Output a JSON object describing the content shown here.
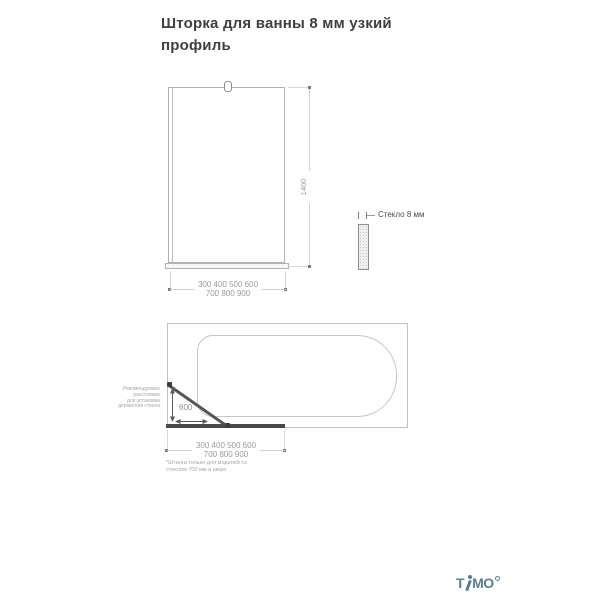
{
  "page": {
    "title_line1": "Шторка для ванны 8 мм узкий",
    "title_line2": "профиль"
  },
  "front_view": {
    "height_dim": "1400",
    "width_row1": "300 400 500 600",
    "width_row2": "700 800 900"
  },
  "glass_section": {
    "label": "Стекло 8 мм"
  },
  "plan_view": {
    "holder_distance": "600",
    "annotation": [
      "Рекомендуемое",
      "расстояние",
      "для установки",
      "держателя стекла"
    ],
    "width_row1": "300 400 500 600",
    "width_row2": "700 800 900",
    "footnote_row1": "*Штанга только для моделей со",
    "footnote_row2": "стеклом 700 мм и шире"
  },
  "branding": {
    "logo_t": "T",
    "logo_mo": "MO"
  },
  "colors": {
    "logo": "#5b7e8c",
    "drawing_line": "#bdbdbd",
    "dim_text": "#9a9a9a",
    "dark_element": "#4a4a4a",
    "title_text": "#3f3f3f"
  }
}
